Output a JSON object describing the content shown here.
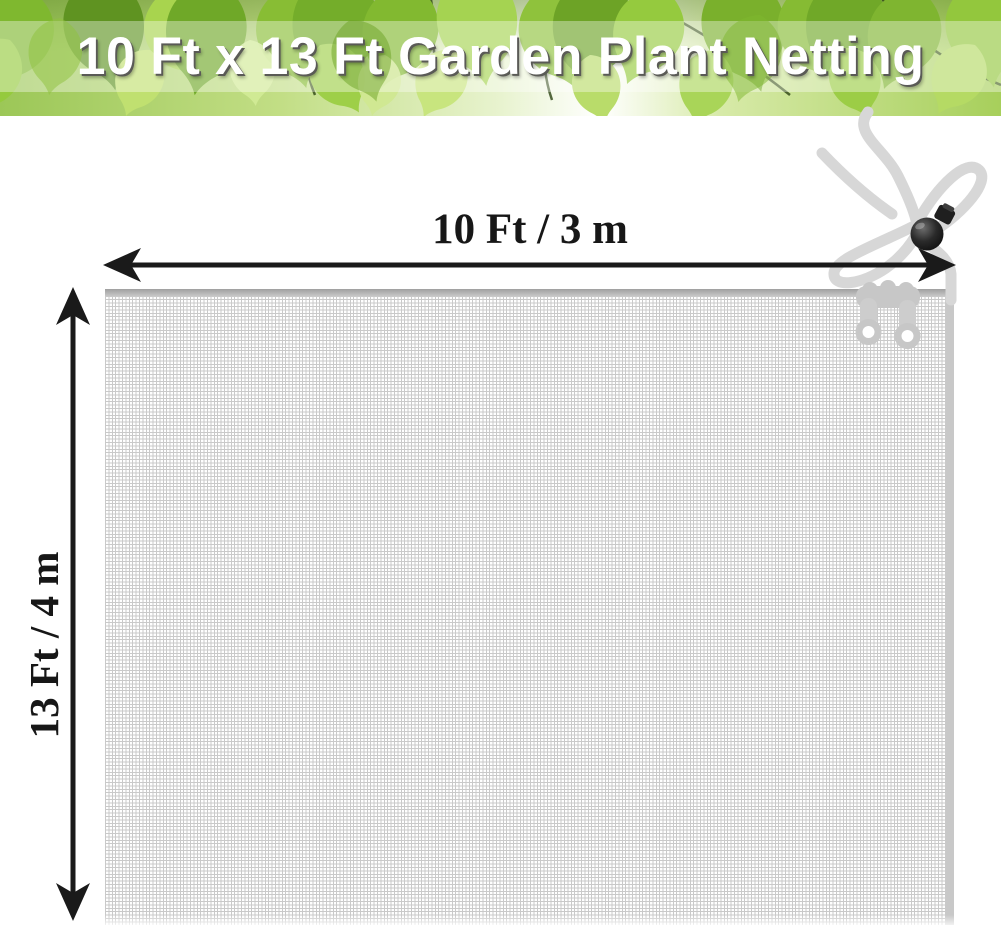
{
  "banner": {
    "title": "10 Ft x 13 Ft Garden Plant Netting"
  },
  "dimensions": {
    "width_label": "10 Ft / 3 m",
    "height_label": "13 Ft / 4 m"
  },
  "colors": {
    "arrow_and_text": "#1a1a1a",
    "dimension_text": "#171717",
    "mesh_line": "#c9c9c9",
    "mesh_seam": "#b3b3b3",
    "rope": "#d7d7d7",
    "cord_lock": "#1c1c1c",
    "zipper_pull": "#c7c7c7",
    "banner_title_text": "#ffffff",
    "banner_leaf_green": "#8fc23c"
  }
}
